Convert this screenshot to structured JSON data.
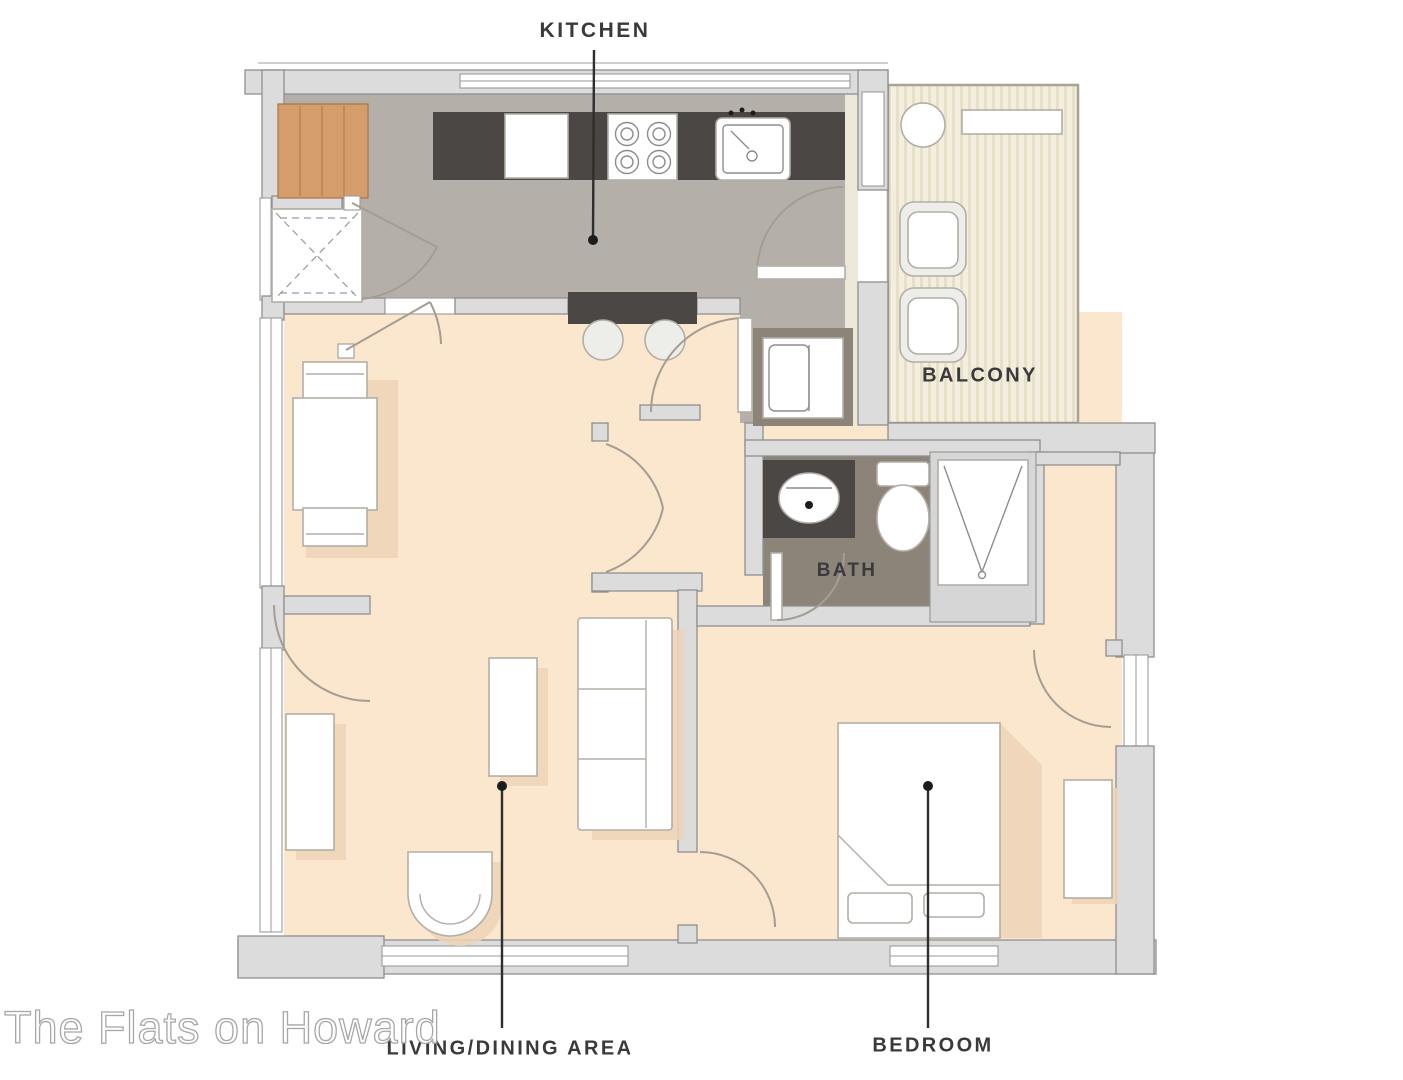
{
  "watermark": "The Flats on Howard",
  "labels": {
    "kitchen": "KITCHEN",
    "balcony": "BALCONY",
    "bath": "BATH",
    "living_dining": "LIVING/DINING AREA",
    "bedroom": "BEDROOM"
  },
  "colors": {
    "floor_living": "#fbe7cd",
    "floor_kitchen": "#b4afa9",
    "floor_bath": "#8d8479",
    "floor_balcony": "#f3eedd",
    "balcony_stripe": "#e6e0c9",
    "wall_fill": "#dcdcdc",
    "wall_stroke": "#8f8f8f",
    "counter_dark": "#4a4744",
    "wood": "#d59d6b",
    "furniture_stroke": "#b3aea6",
    "shadow": "#edd3b8",
    "label_color": "#3a3a3a",
    "leader": "#2f2f2f"
  }
}
